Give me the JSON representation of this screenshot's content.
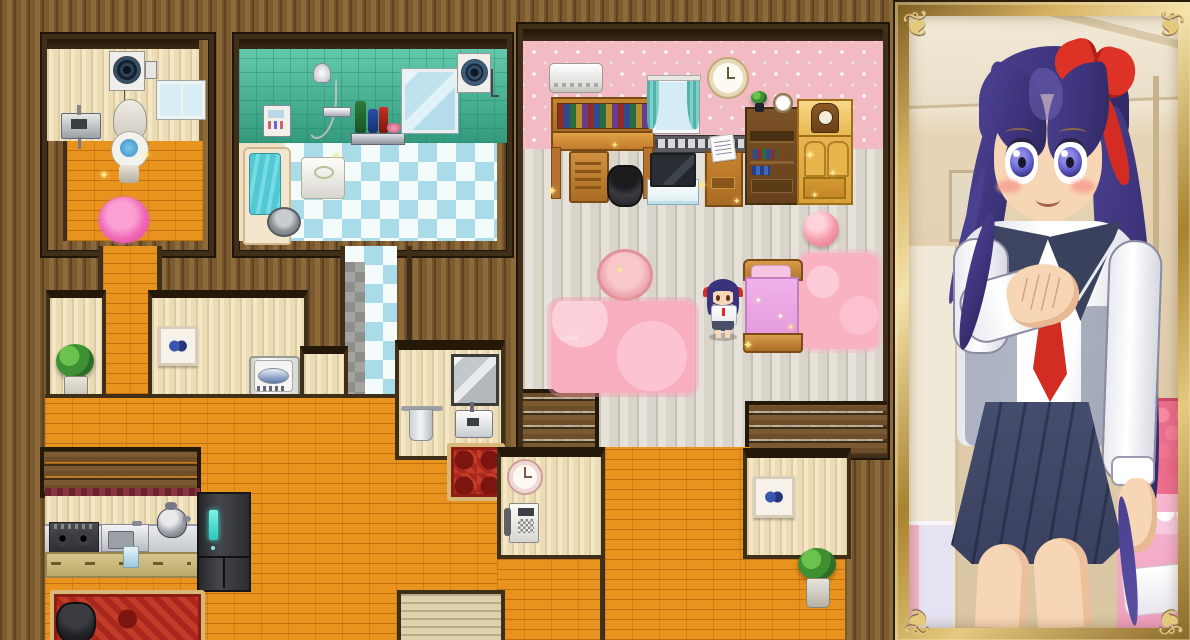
{
  "screen": {
    "kind": "rpg-house-interior-with-portrait",
    "description": "Top-down RPG Maker style house map on the left, framed full-body character portrait on the right"
  },
  "labels": {
    "game_map": "House interior map",
    "toilet_room": "Toilet room",
    "exhaust_fan": "Exhaust fan",
    "power_outlet": "Wall switch",
    "toilet_window": "Window",
    "toilet_sink": "Wash sink",
    "toilet": "Toilet",
    "toilet_rug": "Pink fluffy rug",
    "bathroom": "Bathroom",
    "bath_panel": "Bath control panel",
    "shower": "Hand shower",
    "shampoo_shelf": "Shelf with shampoo bottles",
    "bath_mirror": "Bathroom mirror",
    "vent_fan": "Ventilation fan",
    "bathtub": "Bathtub",
    "bucket": "Wash bucket",
    "bath_stool": "Bath stool",
    "corridor": "Tiled corridor",
    "bedroom": "Bedroom",
    "air_conditioner": "Air conditioner",
    "desk": "Study desk with books",
    "bedroom_window": "Window with teal curtains",
    "bedroom_clock": "Wall clock",
    "tape_rail": "Shelf rail with cassettes",
    "bookshelf": "Bookshelf",
    "shelf_plant": "Small potted plant",
    "alarm_clock": "Alarm clock",
    "wardrobe": "Wardrobe",
    "mantel_clock": "Mantel clock",
    "trash_bin": "Trash bin",
    "tv_stand": "TV on stand",
    "nightstand": "Nightstand with letter",
    "pink_ball": "Pink ball",
    "round_table": "Round pink table",
    "bedroom_rug": "Pink rug",
    "rug_text": "Love",
    "bedside_rug": "Pink fluffy rug",
    "bed": "Bed with pink sheets",
    "heroine": "Heroine character sprite",
    "hallway": "Hallway",
    "plant_left": "Potted plant",
    "butterfly_left": "Butterfly picture",
    "washer": "Washing machine",
    "towel_rack": "Towel rack",
    "hall_mirror": "Mirror",
    "hall_sink": "Hand-wash sink",
    "hall_rug": "Small red rug",
    "hall_clock": "Wall clock",
    "wall_phone": "Wall phone",
    "door_mat": "Entrance mat",
    "butterfly_right": "Butterfly picture",
    "plant_right": "Potted plant",
    "kitchen": "Kitchen",
    "stove": "Gas stove",
    "kitchen_sink": "Kitchen sink",
    "kettle": "Pot on counter",
    "cabinets": "Kitchen base cabinets",
    "glass": "Glass of water",
    "fridge": "Refrigerator",
    "kitchen_rug": "Ornate red carpet",
    "cook_pot": "Cooking pot",
    "portrait": "Character portrait panel",
    "portrait_frame": "Ornate gold frame",
    "character": "Schoolgirl, long purple hair, red ribbon bow, sailor uniform with navy pleated skirt",
    "ceiling_light": "Ceiling light",
    "wall_picture": "Wall picture",
    "pink_headboard": "Pink tufted headboard",
    "pink_bed": "Bed with pink frilled cover",
    "lavender_bed": "Bed corner"
  },
  "colors": {
    "outer_wall_wood": "#7c5a30",
    "room_border": "#3f2e18",
    "cream_wall": "#f4e7c6",
    "teal_tile": "#3aab8b",
    "pink_wallpaper": "#f2bac2",
    "orange_floor": "#e9931f",
    "checker_blue": "#aadbe9",
    "bedroom_plank": "#e6e2d9",
    "rug_red": "#a8281e",
    "rug_pink": "#f6aec4",
    "bed_pink": "#eba0e0",
    "gold_frame": "#d7b364",
    "hair_indigo": "#3b3278",
    "ribbon_red": "#dd3327",
    "uniform_navy": "#3e4563",
    "skin": "#f7d6b6",
    "fridge_teal_light": "#45e6da"
  }
}
